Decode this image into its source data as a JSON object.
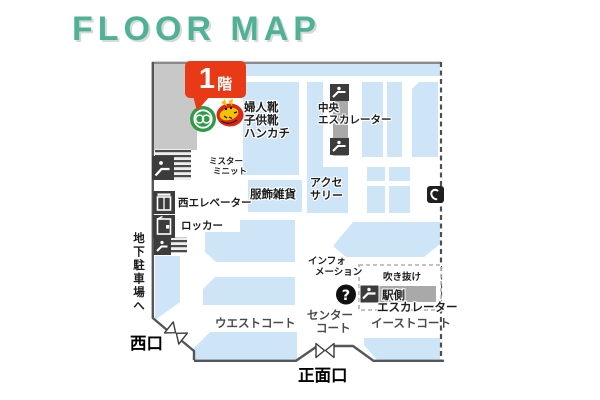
{
  "title": {
    "text": "FLOOR MAP"
  },
  "floor_badge": {
    "number": "1",
    "suffix": "階"
  },
  "areas": {
    "womens_shoes": {
      "lines": [
        "婦人靴",
        "子供靴",
        "ハンカチ"
      ]
    },
    "fashion_goods": {
      "label": "服飾雑貨"
    },
    "accessories": {
      "lines": [
        "アクセ",
        "サリー"
      ]
    },
    "mister_minit": {
      "lines": [
        "ミスター",
        "ミニット"
      ]
    }
  },
  "facilities": {
    "central_escalator": {
      "lines": [
        "中央",
        "エスカレーター"
      ]
    },
    "station_escalator": {
      "lines": [
        "駅側",
        "エスカレーター"
      ]
    },
    "west_elevator": {
      "label": "西エレベーター"
    },
    "locker": {
      "label": "ロッカー"
    },
    "information": {
      "lines": [
        "インフォ",
        "メーション"
      ],
      "mark": "?"
    },
    "atrium": {
      "label": "吹き抜け"
    },
    "underground_parking": {
      "label": "地下駐車場へ"
    }
  },
  "courts": {
    "west_court": {
      "label": "ウエストコート"
    },
    "center_court": {
      "lines": [
        "センター",
        "コート"
      ]
    },
    "east_court": {
      "label": "イーストコート"
    }
  },
  "entrances": {
    "west_exit": {
      "label": "西口"
    },
    "main_entrance": {
      "label": "正面口"
    }
  },
  "colors": {
    "title_teal": "#4fb296",
    "badge_red": "#e83a17",
    "area_blue": "#cde5f6",
    "gray_block": "#c8c8c8",
    "escalator_shaft_gray": "#a9a9a9",
    "icon_dark": "#3c3c3c",
    "wall": "#555555",
    "logo_green": "#2f9b48",
    "mascot_red": "#d9281a",
    "mascot_yellow": "#f2c400"
  }
}
